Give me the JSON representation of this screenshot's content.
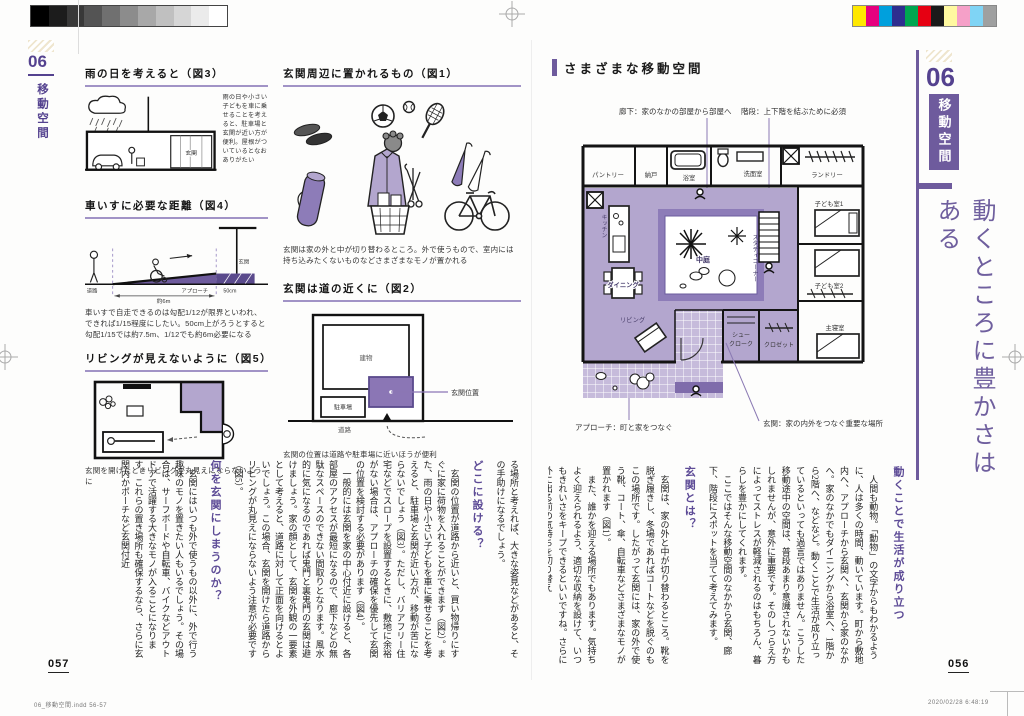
{
  "colors": {
    "accent": "#6e5b9d",
    "light_purple": "#b3a6ce",
    "mid_purple": "#8d7cb8",
    "tile_purple": "#c6bbdb",
    "underline_purple": "#a193c6"
  },
  "print_marks": {
    "grayscale": [
      "#000000",
      "#1c1c1c",
      "#383838",
      "#545454",
      "#707070",
      "#8c8c8c",
      "#a8a8a8",
      "#c0c0c0",
      "#d6d6d6",
      "#ebebeb",
      "#ffffff"
    ],
    "colorbar": [
      "#ffe800",
      "#e6007e",
      "#00a0dd",
      "#2e2e8f",
      "#00a650",
      "#e60012",
      "#1a1a1a",
      "#fff9a0",
      "#f5a0c8",
      "#7fd4f5",
      "#9fa0a0"
    ]
  },
  "left_page": {
    "sidebar": {
      "num": "06",
      "label": "移動空間"
    },
    "fig3": {
      "title": "雨の日を考えると（図3）",
      "caption": "雨の日や小さい子どもを車に乗せることを考えると、駐車場と玄関が近い方が便利。屋根がついているとなおありがたい",
      "label_genkan": "玄関"
    },
    "fig4": {
      "title": "車いすに必要な距離（図4）",
      "caption": "車いすで自走できるのは勾配1/12が限界といわれ、できれば1/15程度にしたい。50cm上がろうとすると勾配1/15では約7.5m、1/12でも約6m必要になる",
      "label_road": "道路",
      "label_approach": "アプローチ",
      "label_dim": "約6m",
      "label_step": "50cm",
      "label_genkan": "玄関"
    },
    "fig5": {
      "title": "リビングが見えないように（図5）",
      "caption": "玄関を開けたときリビングが丸見えにならないように"
    },
    "fig1": {
      "title": "玄関周辺に置かれるもの（図1）",
      "caption": "玄関は家の外と中が切り替わるところ。外で使うもので、室内には持ち込みたくないものなどさまざまなモノが置かれる"
    },
    "fig2": {
      "title": "玄関は道の近くに（図2）",
      "caption": "玄関の位置は道路や駐車場に近いほうが便利",
      "label_building": "建物",
      "label_entrance": "玄関位置",
      "label_parking": "駐車場",
      "label_road": "道路"
    },
    "sections": [
      {
        "type": "p",
        "indent": false,
        "text": "る場所と考えれば、大きな姿見などがあると、その手助けになるでしょう。"
      },
      {
        "type": "h",
        "text": "どこに設ける？"
      },
      {
        "type": "p",
        "text": "玄関の位置が道路から近いと、買い物帰りにすぐに家に荷物を入れることができます（図2）。また、雨の日や小さい子どもを車に乗せることを考えると、駐車場と玄関が近い方が、移動が苦にならないでしょう（図3）。ただし、バリアフリー住宅などでスロープを設置するときに、敷地に余裕がない場合は、アプローチの確保を優先して玄関の位置を検討する必要があります（図4）。"
      },
      {
        "type": "p",
        "text": "一般的には玄関を家の中心付近に設けると、各部屋のアクセスが最短になるので、廊下などの無駄なスペースのできない間取りとなります。風水的に気になるのであれば鬼門と裏鬼門の玄関は避けましょう。家の顔として、玄関を外観の一要素として考えると、道路に対して正面を向けるとよいでしょう。この場合、玄関を開けたら道路からリビングが丸見えにならないよう注意が必要です（図5）。"
      },
      {
        "type": "h",
        "text": "何を玄関にしまうのか？"
      },
      {
        "type": "p",
        "text": "玄関にはいつも外で使うもの以外に、外で行う趣味のモノを置きたい人もいるでしょう。その場合は、サーフボードや自転車、バイクなどアウトドアで活躍する大きなモノが入ることになります。これらの置き場所も確保するなら、さらに玄関内かポーチなど玄関付近"
      }
    ],
    "page_number": "057",
    "footer": "06_移動空間.indd   56-57"
  },
  "right_page": {
    "header": "さまざまな移動空間",
    "floorplan": {
      "callout_hall": "廊下：家のなかの部屋から部屋へ",
      "callout_stairs": "階段：上下階を結ぶために必須",
      "callout_approach": "アプローチ：町と家をつなぐ",
      "callout_entrance": "玄関：家の内外をつなぐ重要な場所",
      "rooms": {
        "pantry": "パントリー",
        "storage": "納戸",
        "bath": "浴室",
        "washroom": "洗面室",
        "laundry": "ランドリー",
        "kitchen": "キッチン",
        "dining": "ダイニング",
        "living": "リビング",
        "courtyard": "中庭",
        "study": "スタディコーナー",
        "kids1": "子ども室1",
        "kids2": "子ども室2",
        "master": "主寝室",
        "shoe1": "シュー",
        "shoe2": "クローク",
        "closet": "クロゼット"
      }
    },
    "sections": [
      {
        "type": "h",
        "text": "動くことで生活が成り立つ"
      },
      {
        "type": "p",
        "text": "人間も動物。「動物」の文字からもわかるように、人は多くの時間、動いています。町から敷地内へ、アプローチから玄関へ、玄関から家のなかへ。家のなかでもダイニングから浴室へ、1階から2階へ、などなど。動くことで生活が成り立っているといっても過言ではありません。こうした移動途中の空間は、普段あまり意識されないかもしれませんが、意外に重要です。そのしつらえ方によってストレスが軽減されるのはもちろん、暮らしを豊かにしてくれます。"
      },
      {
        "type": "p",
        "text": "ここではそんな移動空間のなかから玄関、廊下、階段にスポットを当てて考えてみます。"
      },
      {
        "type": "h",
        "text": "玄関とは？"
      },
      {
        "type": "p",
        "text": "玄関は、家の外と中が切り替わるところ。靴を脱ぎ履きし、冬場であればコートなどを脱ぐのもこの場所です。したがって玄関には、家の外で使う靴、コート、傘、自転車などさまざまなモノが置かれます（図1）。"
      },
      {
        "type": "p",
        "text": "また、誰かを迎える場所でもあります。気持ちよく迎えられるよう、適切な収納を設けて、いつもきれいさをキープできるといいですね。さらに外に出る前の気持ちを切り替え"
      }
    ],
    "sidebar": {
      "num": "06",
      "label": "移動空間",
      "title": "動くところに豊かさはある"
    },
    "page_number": "056",
    "footer": "2020/02/28   6:48:19"
  }
}
